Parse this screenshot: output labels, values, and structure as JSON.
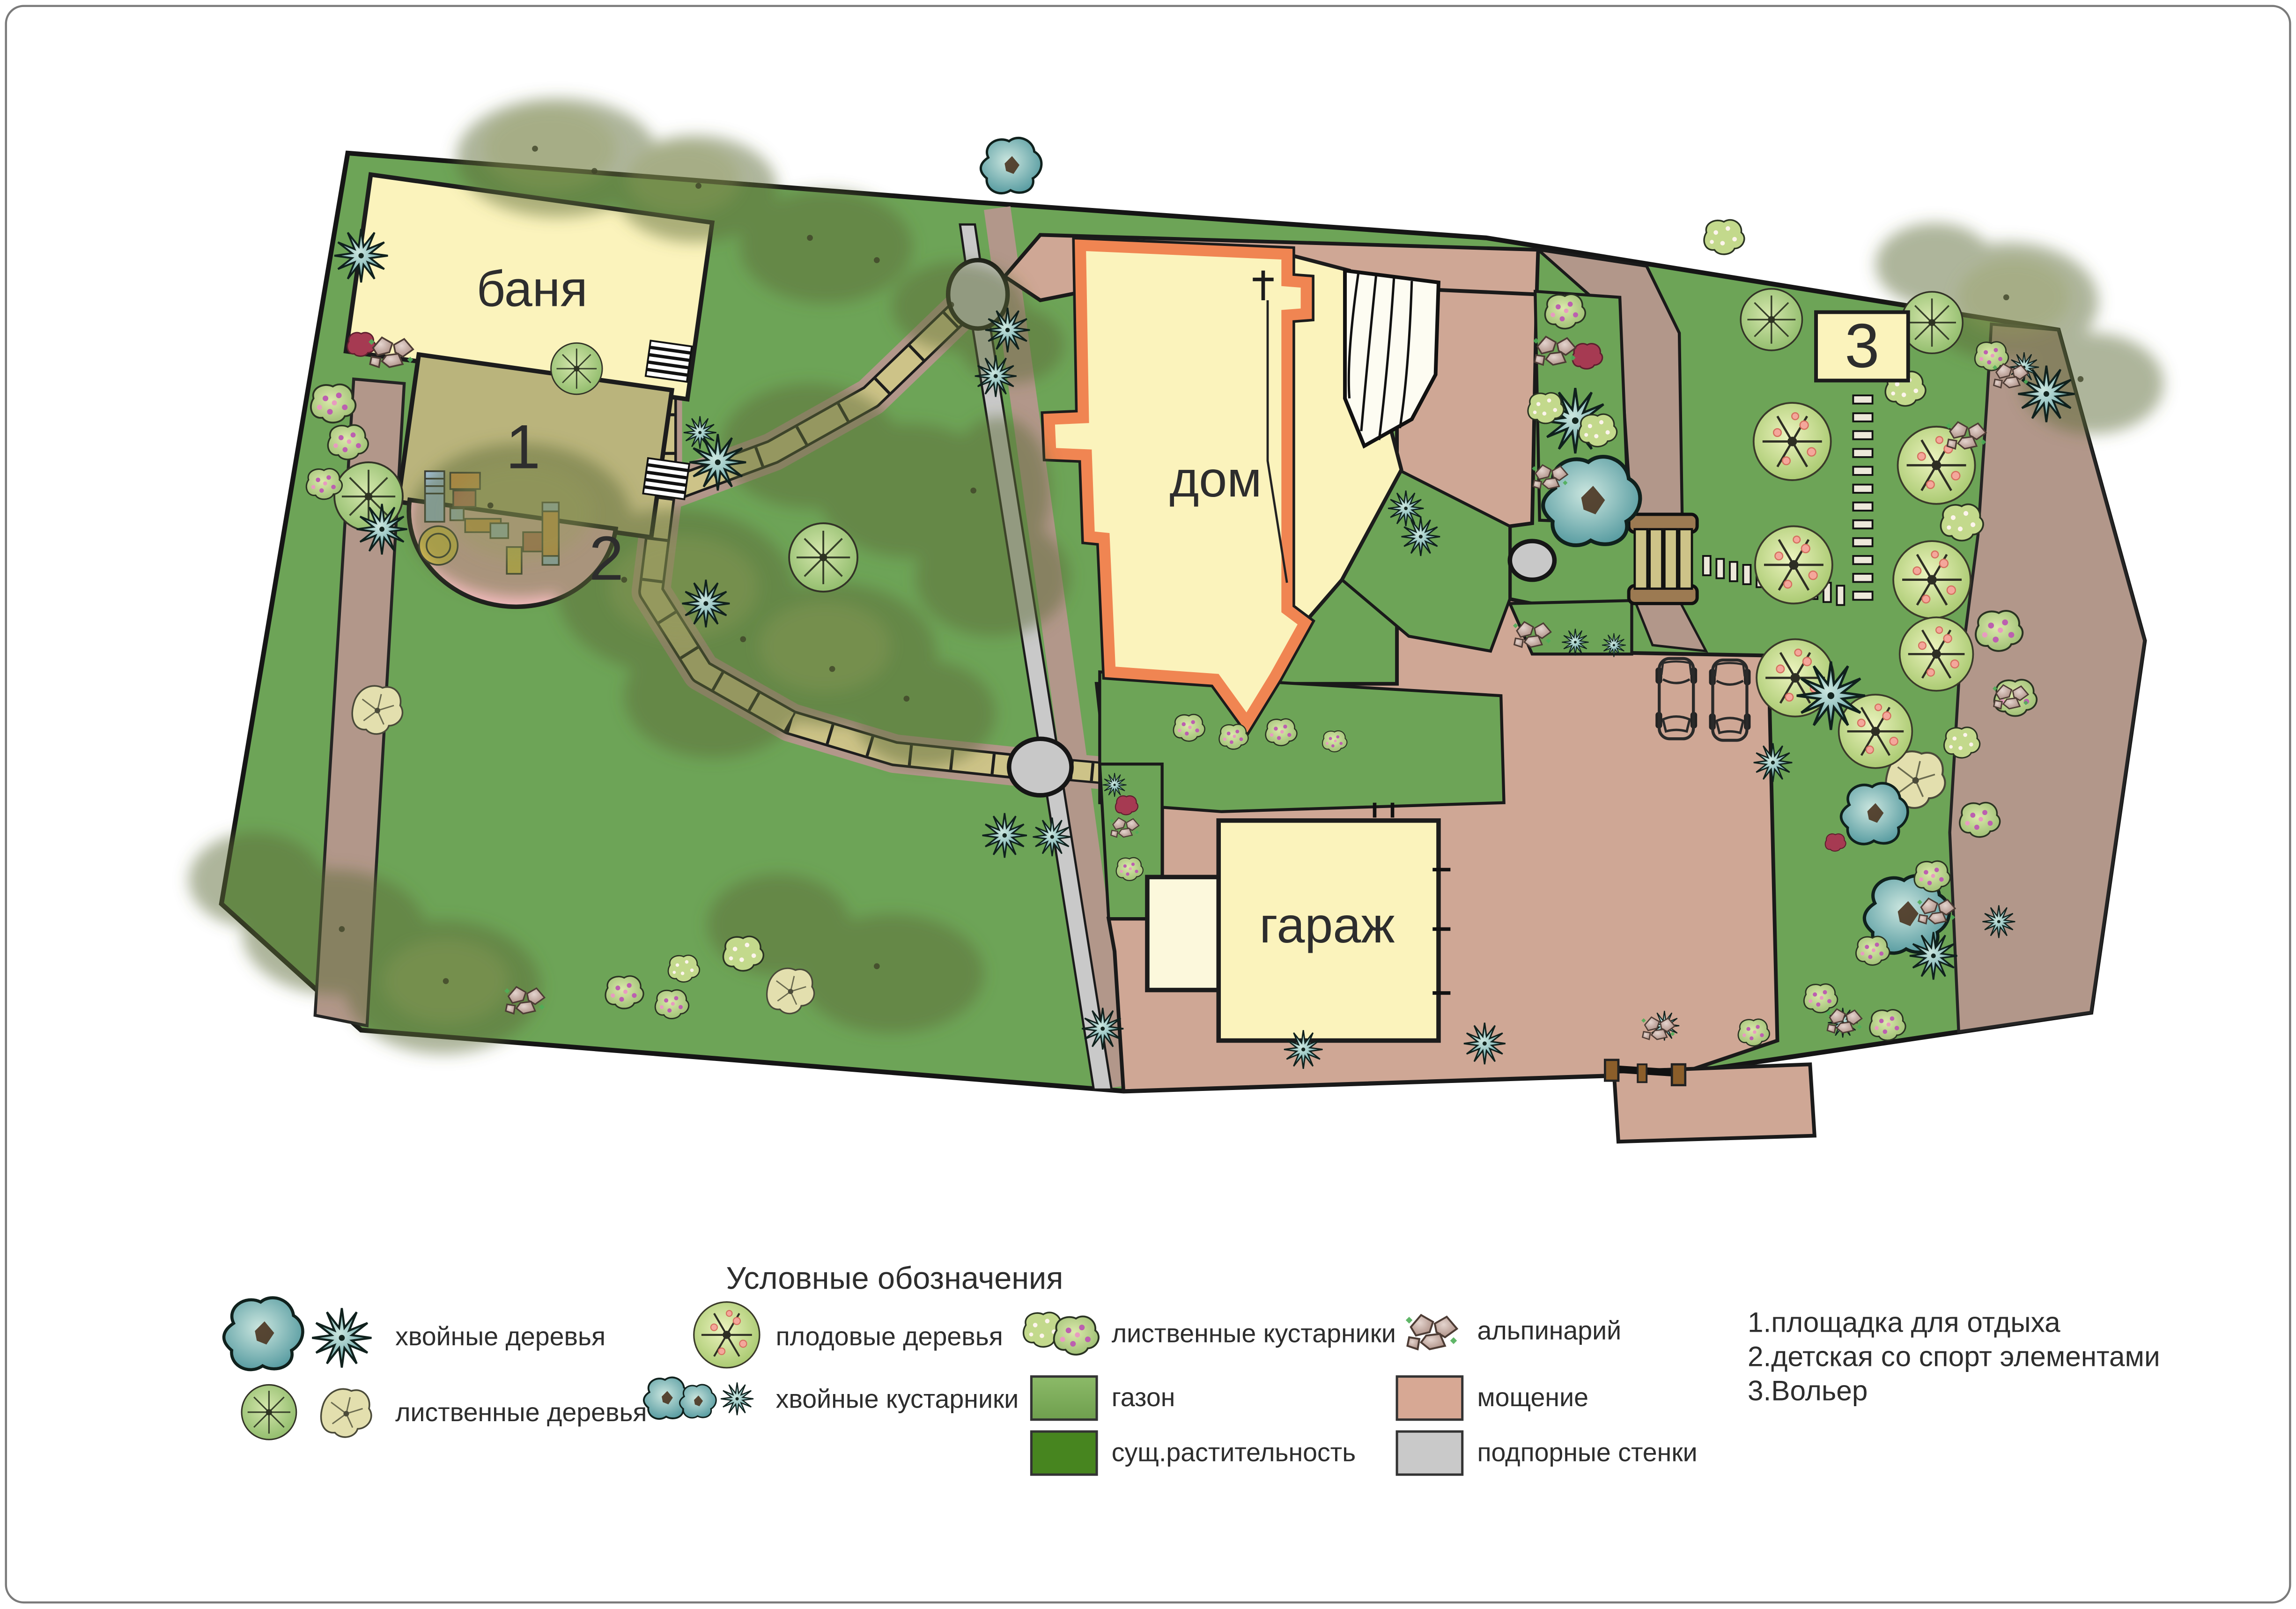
{
  "plan": {
    "buildings": {
      "banya": "баня",
      "house": "дом",
      "garage": "гараж"
    },
    "areas": {
      "area1": "1",
      "area2": "2",
      "area3": "3"
    }
  },
  "legend": {
    "title": "Условные обозначения",
    "items": [
      {
        "icon": "coniferous-trees-icon",
        "label": "хвойные деревья"
      },
      {
        "icon": "deciduous-trees-icon",
        "label": "лиственные деревья"
      },
      {
        "icon": "fruit-trees-icon",
        "label": "плодовые деревья"
      },
      {
        "icon": "coniferous-shrubs-icon",
        "label": "хвойные кустарники"
      },
      {
        "icon": "deciduous-shrubs-icon",
        "label": "лиственные кустарники"
      },
      {
        "icon": "lawn-swatch",
        "label": "газон"
      },
      {
        "icon": "existing-vegetation-swatch",
        "label": "сущ.растительность"
      },
      {
        "icon": "alpinarium-icon",
        "label": "альпинарий"
      },
      {
        "icon": "paving-swatch",
        "label": "мощение"
      },
      {
        "icon": "retaining-walls-swatch",
        "label": "подпорные стенки"
      }
    ],
    "notes": [
      "1.площадка для отдыха",
      "2.детская со спорт элементами",
      "3.Вольер"
    ]
  },
  "colors": {
    "lawn": "#6DA457",
    "existing_vegetation": "#47851F",
    "paving": "#CFA795",
    "dirt_path": "#B2978A",
    "retaining_wall": "#C9C9C9",
    "building_fill": "#FBF3BC",
    "house_outline": "#F08552",
    "area1_fill": "#BAB47C",
    "area2_fill": "#F6BCC0",
    "walkway": "#CDC388"
  }
}
